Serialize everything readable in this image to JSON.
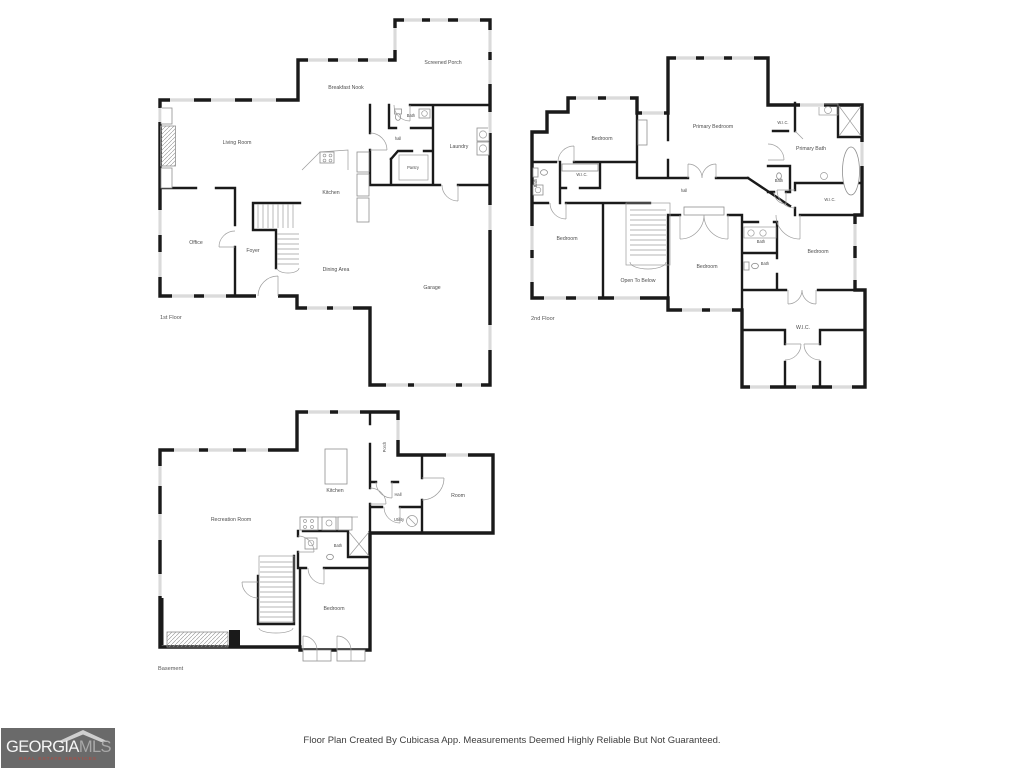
{
  "page": {
    "background": "#ffffff"
  },
  "disclaimer": "Floor Plan Created By Cubicasa App. Measurements Deemed Highly Reliable But Not Guaranteed.",
  "logo": {
    "name": "GEORGIA",
    "suffix": "MLS",
    "tagline": "REAL ESTATE SERVICES",
    "bg_color": "#6a6a6a",
    "name_color": "#f5f5f5",
    "suffix_color": "#a9a9a9",
    "tagline_color": "#a3524a"
  },
  "colors": {
    "wall": "#1a1a1a",
    "fixture": "#8f8f8f",
    "label": "#4d4d4d"
  },
  "floors": {
    "first": {
      "caption": "1st Floor",
      "rooms": {
        "living": "Living Room",
        "breakfast": "Breakfast Nook",
        "screened_porch": "Screened Porch",
        "bath": "Bath",
        "hall": "hall",
        "laundry": "Laundry",
        "pantry": "Pantry",
        "kitchen": "Kitchen",
        "office": "Office",
        "foyer": "Foyer",
        "dining": "Dining Area",
        "garage": "Garage"
      }
    },
    "second": {
      "caption": "2nd Floor",
      "rooms": {
        "bedroom_nw": "Bedroom",
        "primary_bedroom": "Primary Bedroom",
        "wic_primary": "W.I.C.",
        "primary_bath": "Primary Bath",
        "bath_west": "Bath",
        "wic_west": "W.I.C.",
        "hall": "hall",
        "bath_mid": "Bath",
        "wic_east": "W.I.C.",
        "bedroom_w": "Bedroom",
        "open_below": "Open To Below",
        "bedroom_c": "Bedroom",
        "bath_c_upper": "Bath",
        "bath_c_lower": "Bath",
        "bedroom_e": "Bedroom",
        "wic_south": "W.I.C."
      }
    },
    "basement": {
      "caption": "Basement",
      "rooms": {
        "kitchen": "Kitchen",
        "porch": "Porch",
        "hall": "Hall",
        "room": "Room",
        "utility": "Utility",
        "recreation": "Recreation Room",
        "bath": "Bath",
        "bedroom": "Bedroom"
      }
    }
  }
}
